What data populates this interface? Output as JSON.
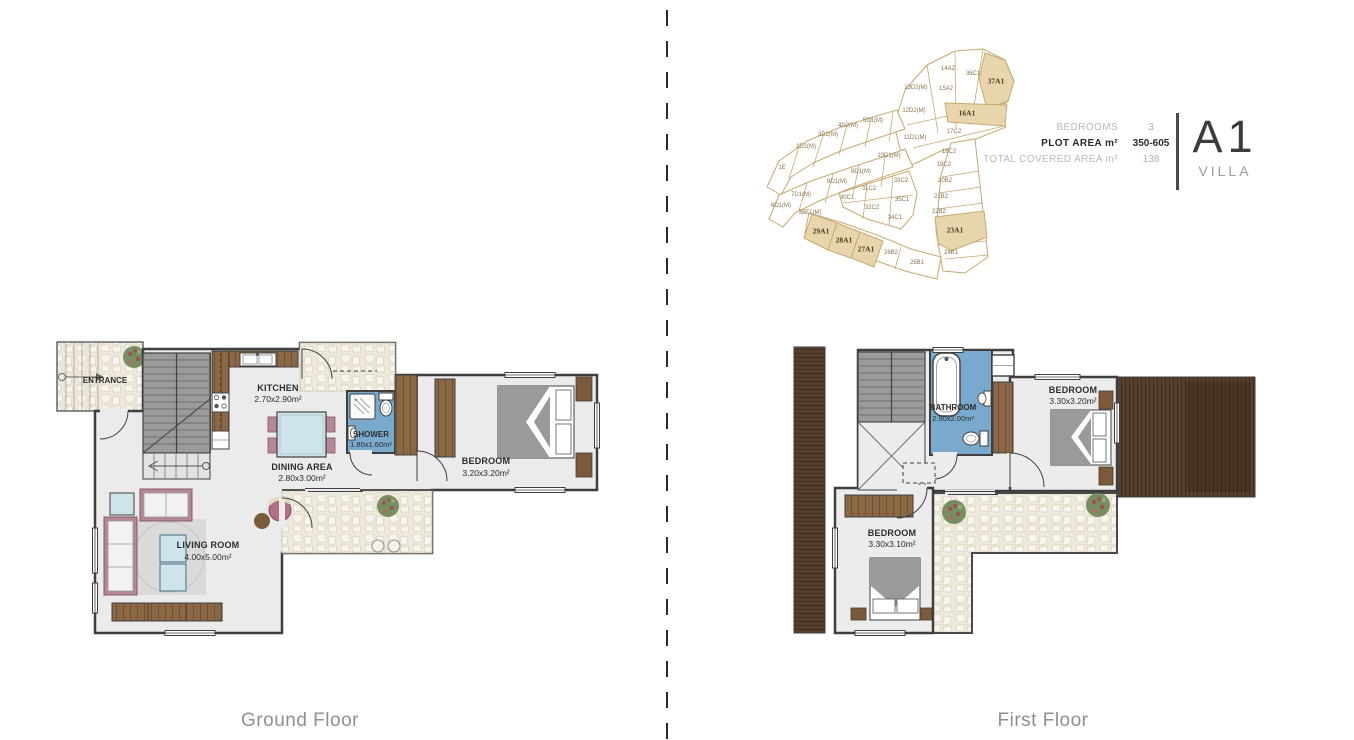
{
  "panel": {
    "specs": [
      {
        "label": "BEDROOMS",
        "value": "3"
      },
      {
        "label": "PLOT AREA m²",
        "value": "350-605"
      },
      {
        "label": "TOTAL COVERED AREA m²",
        "value": "138"
      }
    ],
    "unit_code": "A1",
    "unit_class": "VILLA"
  },
  "ground_floor": {
    "caption": "Ground Floor",
    "rooms": {
      "entrance": {
        "name": "ENTRANCE"
      },
      "kitchen": {
        "name": "KITCHEN",
        "dims": "2.70x2.90m²"
      },
      "dining": {
        "name": "DINING AREA",
        "dims": "2.80x3.00m²"
      },
      "shower": {
        "name": "SHOWER",
        "dims": "1.80x1.60m²"
      },
      "bedroom": {
        "name": "BEDROOM",
        "dims": "3.20x3.20m²"
      },
      "living": {
        "name": "LIVING ROOM",
        "dims": "4.00x5.00m²"
      }
    }
  },
  "first_floor": {
    "caption": "First Floor",
    "rooms": {
      "bathroom": {
        "name": "BATHROOM",
        "dims": "2.90x2.00m²"
      },
      "bedroom_right": {
        "name": "BEDROOM",
        "dims": "3.30x3.20m²"
      },
      "bedroom_left": {
        "name": "BEDROOM",
        "dims": "3.30x3.10m²"
      }
    }
  },
  "siteplan": {
    "highlighted_unit": "A1",
    "plots": [
      {
        "label": "1E",
        "x": 27,
        "y": 163
      },
      {
        "label": "2D2(M)",
        "x": 51,
        "y": 142
      },
      {
        "label": "3D2(M)",
        "x": 73,
        "y": 130
      },
      {
        "label": "4D2(M)",
        "x": 93,
        "y": 121
      },
      {
        "label": "5D1(M)",
        "x": 118,
        "y": 116
      },
      {
        "label": "6D1(M)",
        "x": 26,
        "y": 201
      },
      {
        "label": "7D1(M)",
        "x": 46,
        "y": 190
      },
      {
        "label": "8D1(M)",
        "x": 82,
        "y": 177
      },
      {
        "label": "9D1(M)",
        "x": 106,
        "y": 167
      },
      {
        "label": "10D1(M)",
        "x": 134,
        "y": 151
      },
      {
        "label": "11D1(M)",
        "x": 160,
        "y": 133
      },
      {
        "label": "12D2(M)",
        "x": 159,
        "y": 106
      },
      {
        "label": "13D2(M)",
        "x": 161,
        "y": 83
      },
      {
        "label": "14A2",
        "x": 193,
        "y": 64
      },
      {
        "label": "15A2",
        "x": 191,
        "y": 84
      },
      {
        "label": "16A1",
        "x": 212,
        "y": 108,
        "highlighted": true
      },
      {
        "label": "17C2",
        "x": 199,
        "y": 127
      },
      {
        "label": "18C2",
        "x": 194,
        "y": 147
      },
      {
        "label": "19C2",
        "x": 189,
        "y": 160
      },
      {
        "label": "20B2",
        "x": 190,
        "y": 176
      },
      {
        "label": "21B2",
        "x": 186,
        "y": 192
      },
      {
        "label": "22B2",
        "x": 184,
        "y": 207
      },
      {
        "label": "23A1",
        "x": 200,
        "y": 225,
        "highlighted": true
      },
      {
        "label": "24B1",
        "x": 196,
        "y": 248
      },
      {
        "label": "25B1",
        "x": 162,
        "y": 258
      },
      {
        "label": "26B2",
        "x": 136,
        "y": 248
      },
      {
        "label": "27A1",
        "x": 111,
        "y": 244,
        "highlighted": true
      },
      {
        "label": "28A1",
        "x": 89,
        "y": 235,
        "highlighted": true
      },
      {
        "label": "29A1",
        "x": 66,
        "y": 226,
        "highlighted": true
      },
      {
        "label": "30C1",
        "x": 92,
        "y": 193
      },
      {
        "label": "31C2",
        "x": 114,
        "y": 184
      },
      {
        "label": "32C2",
        "x": 117,
        "y": 203
      },
      {
        "label": "33C2",
        "x": 146,
        "y": 176
      },
      {
        "label": "34C1",
        "x": 140,
        "y": 213
      },
      {
        "label": "35C1",
        "x": 147,
        "y": 195
      },
      {
        "label": "36C1",
        "x": 218,
        "y": 69
      },
      {
        "label": "37A1",
        "x": 241,
        "y": 76,
        "highlighted": true
      },
      {
        "label": "38E1(M)",
        "x": 55,
        "y": 208
      }
    ]
  },
  "colors": {
    "highlight_tan": "#e7d5ad",
    "siteplan_line": "#c7a96f",
    "wet_room_blue": "#79a9cc",
    "wood_brown": "#8b6845",
    "deck_brown": "#584130",
    "wall_gray": "#3f3f3f",
    "spec_label_gray": "#b9b9b9",
    "text_dark": "#2b2b2b"
  }
}
